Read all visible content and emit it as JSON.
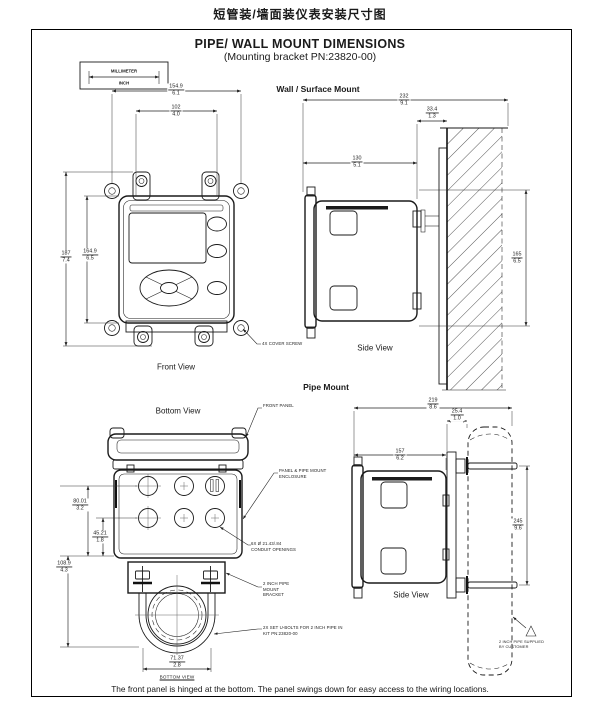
{
  "page": {
    "header_cn": "短管装/墙面装仪表安装尺寸图",
    "title": "PIPE/ WALL MOUNT DIMENSIONS",
    "subtitle": "(Mounting bracket PN:23820-00)",
    "footer_note": "The front panel is hinged at the bottom.  The panel swings down for easy access to the wiring locations."
  },
  "legend": {
    "millimeter": "MILLIMETER",
    "inch": "INCH"
  },
  "wall_mount": {
    "heading": "Wall / Surface Mount",
    "front_view_label": "Front View",
    "side_view_label": "Side View",
    "cover_screw_note": "4X COVER SCREW",
    "dims": {
      "width_outer": {
        "mm": "154.9",
        "inch": "6.1"
      },
      "width_inner": {
        "mm": "102",
        "inch": "4.0"
      },
      "height_outer": {
        "mm": "187",
        "inch": "7.4"
      },
      "height_inner": {
        "mm": "164.9",
        "inch": "6.5"
      },
      "depth_total": {
        "mm": "232",
        "inch": "9.1"
      },
      "bracket_depth": {
        "mm": "33.4",
        "inch": "1.3"
      },
      "enclosure_depth": {
        "mm": "130",
        "inch": "5.1"
      },
      "wall_height": {
        "mm": "165",
        "inch": "6.5"
      }
    }
  },
  "pipe_mount": {
    "heading": "Pipe Mount",
    "bottom_view_label": "Bottom View",
    "side_view_label": "Side View",
    "bottom_view_caption": "BOTTOM VIEW",
    "notes": {
      "front_panel": "FRONT PANEL",
      "enclosure": "PANEL & PIPE MOUNT ENCLOSURE",
      "conduit_openings": "6X Ø 21.43/.84 CONDUIT OPENINGS",
      "pipe_bracket": "2 INCH PIPE MOUNT BRACKET",
      "u_bolts": "2X SET U-BOLTS FOR 2 INCH PIPE IN KIT PN:23820-00",
      "customer_pipe": "2 INCH PIPE SUPPLIED BY CUSTOMER"
    },
    "dims": {
      "opening_offset_a": {
        "mm": "80.01",
        "inch": "3.2"
      },
      "opening_offset_b": {
        "mm": "45.21",
        "inch": "1.8"
      },
      "bottom_height": {
        "mm": "108.9",
        "inch": "4.3"
      },
      "u_bolt_width": {
        "mm": "71.37",
        "inch": "2.8"
      },
      "depth_total": {
        "mm": "219",
        "inch": "8.6"
      },
      "pipe_offset": {
        "mm": "25.4",
        "inch": "1.0"
      },
      "enclosure_depth": {
        "mm": "157",
        "inch": "6.2"
      },
      "bolt_spacing": {
        "mm": "245",
        "inch": "9.6"
      }
    }
  }
}
